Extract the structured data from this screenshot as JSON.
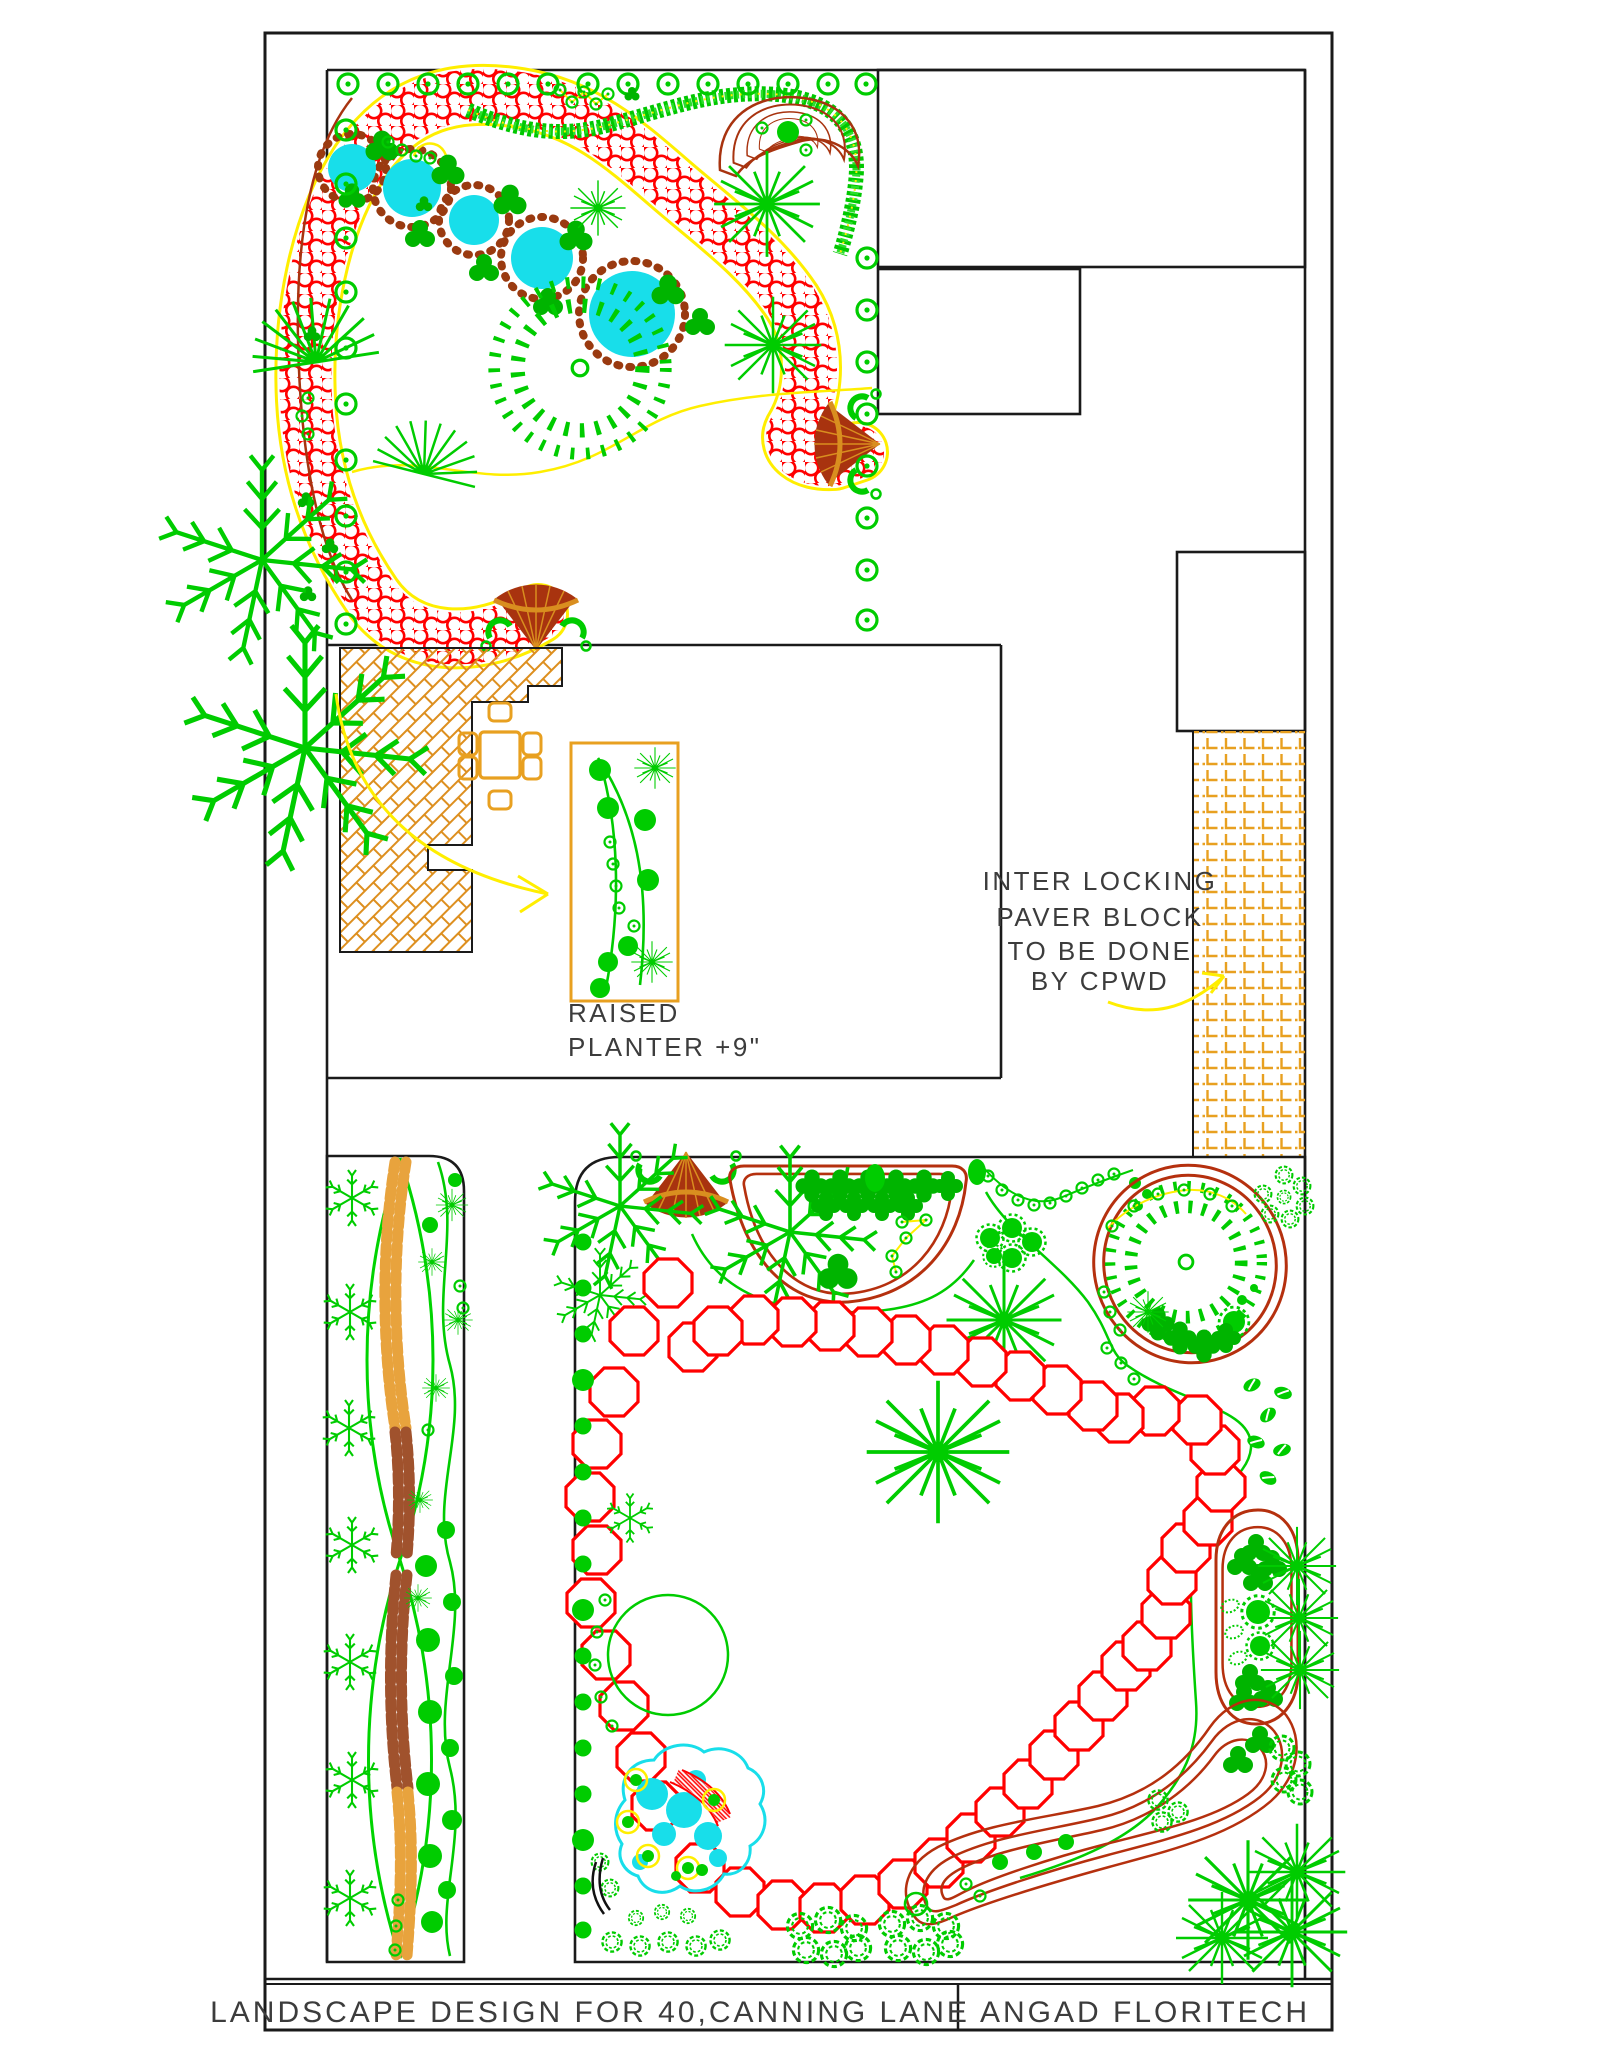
{
  "document": {
    "kind": "landscape architectural plan (CAD plot)",
    "sheet_background": "#FFFFFF"
  },
  "title_block": {
    "project": "LANDSCAPE DESIGN FOR 40,CANNING LANE",
    "firm": "ANGAD FLORITECH"
  },
  "annotations": {
    "paver_note": [
      "INTER LOCKING",
      "PAVER BLOCK",
      "TO BE DONE",
      "BY CPWD"
    ],
    "planter_note": [
      "RAISED",
      "PLANTER +9\""
    ]
  },
  "palette": {
    "line_ink": "#1A1A1A",
    "text": "#3C3C3C",
    "green": "#00CC00",
    "green_dark": "#00A800",
    "green_light": "#2ADF2A",
    "red": "#FF0000",
    "dark_red": "#A8330F",
    "bed_outline": "#B5300E",
    "stone_brown": "#9A3A10",
    "pebble_orange": "#E8A33D",
    "pebble_brown": "#A0522D",
    "furniture_orange": "#E8A020",
    "herringbone_orange": "#DD8F1F",
    "yellow": "#FFEE00",
    "water_cyan": "#18DEEA"
  },
  "features": [
    {
      "name": "top-ornamental-garden",
      "items": [
        "shrub-ring-border",
        "red-flowerbed-ribbon",
        "pond-chain-with-stones",
        "clipped-hedge",
        "crescent-bed",
        "palm-fan-trees",
        "starburst-trees",
        "radial-palm"
      ]
    },
    {
      "name": "courtyard",
      "items": [
        "herringbone-paved-patio",
        "dining-table-with-chairs",
        "raised-planter",
        "leader-arrow"
      ]
    },
    {
      "name": "interlocking-paver-walk",
      "items": [
        "paver-block-hatch",
        "leader-arrow"
      ]
    },
    {
      "name": "left-planting-strip",
      "items": [
        "pebble-braid-path",
        "crossing-bed-arcs",
        "snowflake-trees",
        "shrub-dots"
      ]
    },
    {
      "name": "main-rear-garden",
      "items": [
        "octagonal-stepping-stones",
        "half-moon-bed",
        "oval-palm-bed",
        "capsule-bed",
        "comma-bed",
        "lily-pond",
        "flower-clusters",
        "starburst-trees"
      ]
    }
  ]
}
